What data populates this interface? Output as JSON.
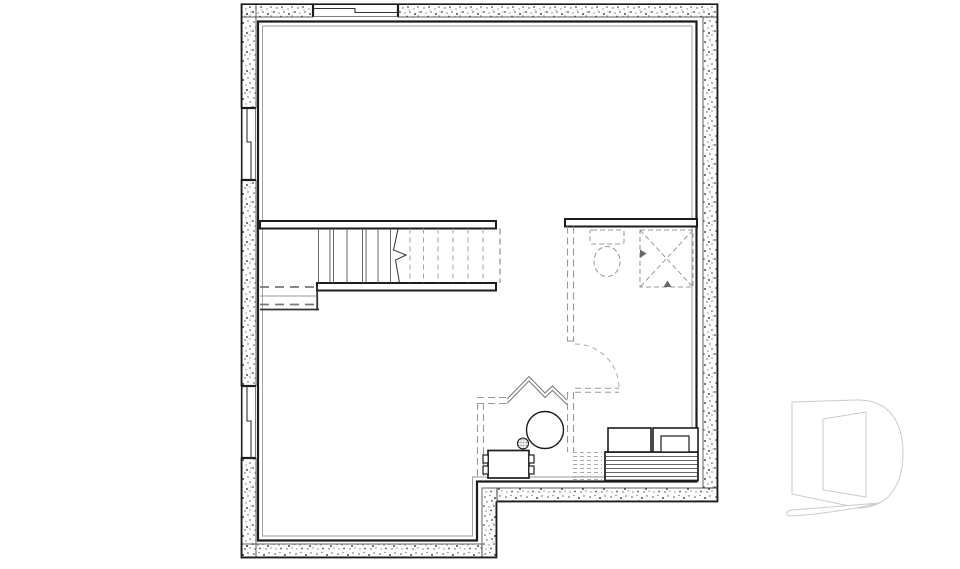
{
  "meta": {
    "title": "Basement floor plan drawing",
    "width": 960,
    "height": 569
  },
  "colors": {
    "background": "#ffffff",
    "dark": "#1c1c1c",
    "ink": "#333333",
    "mid": "#555555",
    "gray": "#777777",
    "soft": "#999999",
    "faint": "#aaaaaa",
    "band_edge": "#3a3a3a",
    "speck": "#4a4a4a",
    "white": "#ffffff",
    "watermark": "#cbcbcb",
    "arrow": "#666666"
  },
  "dashes": {
    "wall": "7 4",
    "fixture": "5 3",
    "tread": "5 4",
    "fine": "4 3",
    "open": "6 4",
    "beam": "9 6"
  },
  "plan": {
    "stipple_bands": [
      {
        "name": "wall-top-left-of-window",
        "x": 242,
        "y": 4,
        "w": 71,
        "h": 13
      },
      {
        "name": "wall-top-right-of-window",
        "x": 398,
        "y": 4,
        "w": 320,
        "h": 13
      },
      {
        "name": "wall-right",
        "x": 703,
        "y": 17,
        "w": 15,
        "h": 471
      },
      {
        "name": "wall-bottom-right",
        "x": 497,
        "y": 488,
        "w": 221,
        "h": 14
      },
      {
        "name": "wall-step",
        "x": 482,
        "y": 488,
        "w": 15,
        "h": 70
      },
      {
        "name": "wall-bottom-left",
        "x": 241,
        "y": 544,
        "w": 241,
        "h": 14
      },
      {
        "name": "wall-left-upper",
        "x": 241,
        "y": 4,
        "w": 15,
        "h": 104
      },
      {
        "name": "wall-left-middle",
        "x": 241,
        "y": 180,
        "w": 15,
        "h": 206
      },
      {
        "name": "wall-left-lower",
        "x": 241,
        "y": 458,
        "w": 15,
        "h": 100
      }
    ],
    "elements": [
      {
        "name": "outer-face-top",
        "type": "line",
        "x1": 241,
        "y1": 4.2,
        "x2": 718,
        "y2": 4.2,
        "stroke": "dark",
        "sw": 1.6
      },
      {
        "name": "outer-face-right",
        "type": "line",
        "x1": 717.3,
        "y1": 4,
        "x2": 717.3,
        "y2": 502,
        "stroke": "dark",
        "sw": 1.6
      },
      {
        "name": "outer-face-bottom-right",
        "type": "line",
        "x1": 497,
        "y1": 501.3,
        "x2": 718,
        "y2": 501.3,
        "stroke": "dark",
        "sw": 1.6
      },
      {
        "name": "outer-face-step",
        "type": "line",
        "x1": 496.3,
        "y1": 501.5,
        "x2": 496.3,
        "y2": 558,
        "stroke": "dark",
        "sw": 1.6
      },
      {
        "name": "outer-face-bottom-left",
        "type": "line",
        "x1": 241,
        "y1": 557.3,
        "x2": 497,
        "y2": 557.3,
        "stroke": "dark",
        "sw": 1.6
      },
      {
        "name": "outer-face-left",
        "type": "line",
        "x1": 241.7,
        "y1": 4,
        "x2": 241.7,
        "y2": 558,
        "stroke": "dark",
        "sw": 1.6
      },
      {
        "name": "window-top-cap-left",
        "type": "line",
        "x1": 313,
        "y1": 4,
        "x2": 313,
        "y2": 17,
        "stroke": "dark",
        "sw": 2.2
      },
      {
        "name": "window-top-cap-right",
        "type": "line",
        "x1": 398,
        "y1": 4,
        "x2": 398,
        "y2": 17,
        "stroke": "dark",
        "sw": 2.2
      },
      {
        "name": "window-top-glazing",
        "type": "polyline",
        "pts": [
          [
            313,
            8.5
          ],
          [
            355,
            8.5
          ],
          [
            355,
            12.5
          ],
          [
            398,
            12.5
          ]
        ],
        "stroke": "ink",
        "sw": 1.1
      },
      {
        "name": "window-top-inner-edge",
        "type": "line",
        "x1": 313,
        "y1": 16.5,
        "x2": 398,
        "y2": 16.5,
        "stroke": "mid",
        "sw": 0.8
      },
      {
        "name": "window-left1-cap-top",
        "type": "line",
        "x1": 241,
        "y1": 108,
        "x2": 256,
        "y2": 108,
        "stroke": "dark",
        "sw": 2.2
      },
      {
        "name": "window-left1-cap-bottom",
        "type": "line",
        "x1": 241,
        "y1": 180,
        "x2": 256,
        "y2": 180,
        "stroke": "dark",
        "sw": 2.2
      },
      {
        "name": "window-left1-glazing",
        "type": "polyline",
        "pts": [
          [
            247,
            108
          ],
          [
            247,
            142
          ],
          [
            251,
            142
          ],
          [
            251,
            180
          ]
        ],
        "stroke": "ink",
        "sw": 1.1
      },
      {
        "name": "window-left1-inner-edge",
        "type": "line",
        "x1": 255.5,
        "y1": 108,
        "x2": 255.5,
        "y2": 180,
        "stroke": "mid",
        "sw": 0.8
      },
      {
        "name": "window-left2-cap-top",
        "type": "line",
        "x1": 241,
        "y1": 386,
        "x2": 256,
        "y2": 386,
        "stroke": "dark",
        "sw": 2.2
      },
      {
        "name": "window-left2-cap-bottom",
        "type": "line",
        "x1": 241,
        "y1": 458,
        "x2": 256,
        "y2": 458,
        "stroke": "dark",
        "sw": 2.2
      },
      {
        "name": "window-left2-glazing",
        "type": "polyline",
        "pts": [
          [
            247,
            386
          ],
          [
            247,
            421
          ],
          [
            251,
            421
          ],
          [
            251,
            458
          ]
        ],
        "stroke": "ink",
        "sw": 1.1
      },
      {
        "name": "window-left2-inner-edge",
        "type": "line",
        "x1": 255.5,
        "y1": 386,
        "x2": 255.5,
        "y2": 458,
        "stroke": "mid",
        "sw": 0.8
      },
      {
        "name": "interior-face-outline",
        "type": "polygon",
        "pts": [
          [
            258,
            21.5
          ],
          [
            696.5,
            21.5
          ],
          [
            696.5,
            481.5
          ],
          [
            477,
            481.5
          ],
          [
            477,
            540.5
          ],
          [
            258,
            540.5
          ]
        ],
        "stroke": "dark",
        "sw": 2.2,
        "fill": "none"
      },
      {
        "name": "interior-furring-line",
        "type": "polygon",
        "pts": [
          [
            262.5,
            26
          ],
          [
            692,
            26
          ],
          [
            692,
            477
          ],
          [
            472.5,
            477
          ],
          [
            472.5,
            536
          ],
          [
            262.5,
            536
          ]
        ],
        "stroke": "soft",
        "sw": 0.9,
        "fill": "none"
      },
      {
        "name": "stair-top-wall",
        "type": "rect",
        "x": 260,
        "y": 221,
        "w": 236,
        "h": 7.5,
        "stroke": "dark",
        "sw": 2,
        "fill": "white"
      },
      {
        "name": "stair-bottom-wall",
        "type": "rect",
        "x": 317,
        "y": 283,
        "w": 179,
        "h": 7.5,
        "stroke": "dark",
        "sw": 2,
        "fill": "white"
      },
      {
        "name": "stair-treads-solid",
        "type": "vlines",
        "xs": [
          318.5,
          330,
          333.5,
          347,
          362.5,
          366,
          378,
          390.5
        ],
        "y1": 228.5,
        "y2": 283,
        "stroke": "mid",
        "sw": 0.9
      },
      {
        "name": "stair-break-line",
        "type": "polyline",
        "pts": [
          [
            398,
            229
          ],
          [
            393.5,
            250
          ],
          [
            406,
            255
          ],
          [
            395.5,
            260
          ],
          [
            399.5,
            283
          ]
        ],
        "stroke": "ink",
        "sw": 1
      },
      {
        "name": "stair-treads-hidden",
        "type": "vlines",
        "xs": [
          410,
          423.5,
          438,
          453,
          468,
          483
        ],
        "y1": 228.5,
        "y2": 283,
        "stroke": "soft",
        "sw": 0.9,
        "dash": "tread"
      },
      {
        "name": "stair-opening-edge",
        "type": "line",
        "x1": 500,
        "y1": 228.5,
        "x2": 500,
        "y2": 283,
        "stroke": "gray",
        "sw": 1,
        "dash": "open"
      },
      {
        "name": "landing-beam-upper",
        "type": "line",
        "x1": 260,
        "y1": 287,
        "x2": 316,
        "y2": 287,
        "stroke": "gray",
        "sw": 1.8,
        "dash": "beam"
      },
      {
        "name": "landing-mid-line",
        "type": "line",
        "x1": 260,
        "y1": 296,
        "x2": 316,
        "y2": 296,
        "stroke": "soft",
        "sw": 0.9
      },
      {
        "name": "landing-beam-lower",
        "type": "line",
        "x1": 260,
        "y1": 304.5,
        "x2": 316,
        "y2": 304.5,
        "stroke": "gray",
        "sw": 1.8,
        "dash": "beam"
      },
      {
        "name": "landing-front-edge",
        "type": "line",
        "x1": 260,
        "y1": 309.5,
        "x2": 319,
        "y2": 309.5,
        "stroke": "ink",
        "sw": 1.8
      },
      {
        "name": "landing-side-edge",
        "type": "line",
        "x1": 317.2,
        "y1": 286,
        "x2": 317.2,
        "y2": 310.5,
        "stroke": "ink",
        "sw": 1.8
      },
      {
        "name": "bathroom-front-wall",
        "type": "rect",
        "x": 565,
        "y": 219,
        "w": 132,
        "h": 7.5,
        "stroke": "dark",
        "sw": 2,
        "fill": "white"
      },
      {
        "name": "future-wall-upper-a",
        "type": "line",
        "x1": 567.5,
        "y1": 226.5,
        "x2": 567.5,
        "y2": 341,
        "stroke": "soft",
        "sw": 1.1,
        "dash": "wall"
      },
      {
        "name": "future-wall-upper-b",
        "type": "line",
        "x1": 573.5,
        "y1": 226.5,
        "x2": 573.5,
        "y2": 341,
        "stroke": "soft",
        "sw": 1.1,
        "dash": "wall"
      },
      {
        "name": "future-wall-jamb",
        "type": "line",
        "x1": 567,
        "y1": 341,
        "x2": 574,
        "y2": 341,
        "stroke": "soft",
        "sw": 1.1
      },
      {
        "name": "future-door-swing",
        "type": "path",
        "d": "M575,344 A44,44 0 0 1 619,388",
        "stroke": "faint",
        "sw": 1,
        "dash": "tread",
        "fill": "none"
      },
      {
        "name": "future-door-leaf-a",
        "type": "line",
        "x1": 575,
        "y1": 388.2,
        "x2": 619,
        "y2": 388.2,
        "stroke": "soft",
        "sw": 1,
        "dash": "open"
      },
      {
        "name": "future-door-leaf-b",
        "type": "line",
        "x1": 575,
        "y1": 392.2,
        "x2": 619,
        "y2": 392.2,
        "stroke": "soft",
        "sw": 1,
        "dash": "open"
      },
      {
        "name": "future-wall-lower-a",
        "type": "line",
        "x1": 567.5,
        "y1": 392,
        "x2": 567.5,
        "y2": 452,
        "stroke": "soft",
        "sw": 1.1,
        "dash": "wall"
      },
      {
        "name": "future-wall-lower-b",
        "type": "line",
        "x1": 573.5,
        "y1": 392,
        "x2": 573.5,
        "y2": 452,
        "stroke": "soft",
        "sw": 1.1,
        "dash": "wall"
      },
      {
        "name": "toilet-tank",
        "type": "rect",
        "x": 590,
        "y": 230,
        "w": 34,
        "h": 14,
        "rx": 2,
        "stroke": "soft",
        "sw": 1.05,
        "dash": "fixture",
        "fill": "none"
      },
      {
        "name": "toilet-bowl",
        "type": "ellipse",
        "cx": 607,
        "cy": 261.5,
        "rx": 13,
        "ry": 15,
        "stroke": "soft",
        "sw": 1.05,
        "dash": "fixture",
        "fill": "none"
      },
      {
        "name": "shower-base",
        "type": "rect",
        "x": 640,
        "y": 230,
        "w": 53,
        "h": 57,
        "stroke": "soft",
        "sw": 1.05,
        "dash": "fixture",
        "fill": "none"
      },
      {
        "name": "shower-diagonal-a",
        "type": "line",
        "x1": 640,
        "y1": 230,
        "x2": 693,
        "y2": 287,
        "stroke": "soft",
        "sw": 1,
        "dash": "fixture"
      },
      {
        "name": "shower-diagonal-b",
        "type": "line",
        "x1": 693,
        "y1": 230,
        "x2": 640,
        "y2": 287,
        "stroke": "soft",
        "sw": 1,
        "dash": "fixture"
      },
      {
        "name": "shower-slope-arrow-left",
        "type": "polygon",
        "pts": [
          [
            640,
            249.5
          ],
          [
            640,
            258
          ],
          [
            646.5,
            253.5
          ]
        ],
        "stroke": "none",
        "sw": 0,
        "fill": "arrow"
      },
      {
        "name": "shower-slope-arrow-bottom",
        "type": "polygon",
        "pts": [
          [
            663.5,
            287
          ],
          [
            671.5,
            287
          ],
          [
            667.5,
            280.5
          ]
        ],
        "stroke": "none",
        "sw": 0,
        "fill": "arrow"
      },
      {
        "name": "future-partition-h-a",
        "type": "line",
        "x1": 477,
        "y1": 397.5,
        "x2": 507,
        "y2": 397.5,
        "stroke": "soft",
        "sw": 1.1,
        "dash": "wall"
      },
      {
        "name": "future-partition-h-b",
        "type": "line",
        "x1": 477,
        "y1": 403.5,
        "x2": 507,
        "y2": 403.5,
        "stroke": "soft",
        "sw": 1.1,
        "dash": "wall"
      },
      {
        "name": "future-partition-v-a",
        "type": "line",
        "x1": 477.5,
        "y1": 403,
        "x2": 477.5,
        "y2": 481,
        "stroke": "soft",
        "sw": 1.1,
        "dash": "wall"
      },
      {
        "name": "future-partition-v-b",
        "type": "line",
        "x1": 483.5,
        "y1": 403,
        "x2": 483.5,
        "y2": 481,
        "stroke": "soft",
        "sw": 1.1,
        "dash": "wall"
      },
      {
        "name": "angled-partition-outer",
        "type": "polyline",
        "pts": [
          [
            507,
            399
          ],
          [
            529,
            376.5
          ],
          [
            545,
            393
          ],
          [
            552.5,
            386
          ],
          [
            567,
            400
          ]
        ],
        "stroke": "gray",
        "sw": 1
      },
      {
        "name": "angled-partition-inner",
        "type": "polyline",
        "pts": [
          [
            507,
            403.5
          ],
          [
            529,
            381
          ],
          [
            545,
            397.5
          ],
          [
            552.5,
            390.5
          ],
          [
            567,
            404.5
          ]
        ],
        "stroke": "gray",
        "sw": 1
      },
      {
        "name": "water-heater",
        "type": "circle",
        "cx": 545,
        "cy": 430,
        "r": 18.5,
        "stroke": "dark",
        "sw": 1.4,
        "fill": "white"
      },
      {
        "name": "floor-drain",
        "type": "circle",
        "cx": 523,
        "cy": 443.5,
        "r": 5.5,
        "stroke": "dark",
        "sw": 1.1,
        "fill": "hatch"
      },
      {
        "name": "table",
        "type": "rect",
        "x": 488,
        "y": 450.5,
        "w": 41,
        "h": 27.5,
        "stroke": "dark",
        "sw": 1.7,
        "fill": "white"
      },
      {
        "name": "chair-left-1",
        "type": "rect",
        "x": 483,
        "y": 455,
        "w": 5.2,
        "h": 8,
        "stroke": "dark",
        "sw": 1.2,
        "fill": "white"
      },
      {
        "name": "chair-left-2",
        "type": "rect",
        "x": 483,
        "y": 466,
        "w": 5.2,
        "h": 8,
        "stroke": "dark",
        "sw": 1.2,
        "fill": "white"
      },
      {
        "name": "chair-right-1",
        "type": "rect",
        "x": 528.8,
        "y": 455,
        "w": 5.2,
        "h": 8,
        "stroke": "dark",
        "sw": 1.2,
        "fill": "white"
      },
      {
        "name": "chair-right-2",
        "type": "rect",
        "x": 528.8,
        "y": 466,
        "w": 5.2,
        "h": 8,
        "stroke": "dark",
        "sw": 1.2,
        "fill": "white"
      },
      {
        "name": "bench-hidden-stripes",
        "type": "hlines",
        "ys": [
          452.5,
          456.5,
          460.5,
          464.5,
          468.5,
          472.5,
          476.5,
          479.5
        ],
        "x1": 573,
        "x2": 602,
        "stroke": "faint",
        "sw": 0.9,
        "dash": "fine"
      },
      {
        "name": "bench-striped-base",
        "type": "rect",
        "x": 605,
        "y": 452,
        "w": 93,
        "h": 28.5,
        "stroke": "dark",
        "sw": 1.7,
        "fill": "white"
      },
      {
        "name": "bench-stripes",
        "type": "hlines",
        "ys": [
          456.5,
          460.5,
          464.5,
          468.5,
          472.5,
          476.5
        ],
        "x1": 605.8,
        "x2": 697.2,
        "stroke": "ink",
        "sw": 0.8
      },
      {
        "name": "appliance-box-left",
        "type": "rect",
        "x": 608,
        "y": 428,
        "w": 43,
        "h": 24,
        "stroke": "dark",
        "sw": 1.6,
        "fill": "white"
      },
      {
        "name": "appliance-box-right",
        "type": "rect",
        "x": 653,
        "y": 428,
        "w": 45,
        "h": 24,
        "stroke": "dark",
        "sw": 1.6,
        "fill": "white"
      },
      {
        "name": "appliance-box-right-inner",
        "type": "rect",
        "x": 661,
        "y": 436,
        "w": 28,
        "h": 16,
        "stroke": "dark",
        "sw": 1.2,
        "fill": "white"
      }
    ]
  },
  "watermark": {
    "name": "d-logo-watermark",
    "paths": [
      {
        "name": "d-logo-body",
        "d": "M792,402 L856,400 C888,399 903,421 903,453 C903,486 888,507 859,508 L792,494 Z M823,419 L866,412 L866,497 L823,490 Z"
      },
      {
        "name": "d-logo-swoosh",
        "d": "M789,516 C785,514 787,511 792,510 L880,503 C855,509 815,515 789,516 Z"
      }
    ]
  }
}
